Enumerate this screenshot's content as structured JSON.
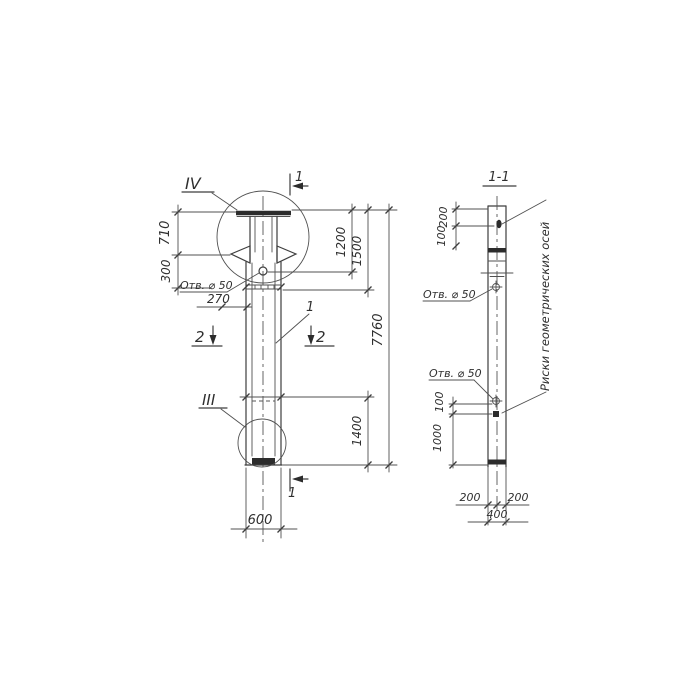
{
  "drawing": {
    "front_view": {
      "detail_top_label": "IV",
      "detail_bottom_label": "III",
      "section1_top_label": "1",
      "section1_bottom_label": "1",
      "section2_left_label": "2",
      "section2_right_label": "2",
      "part_callout": "1",
      "hole_note": "Отв. ⌀ 50",
      "dim_710": "710",
      "dim_300": "300",
      "dim_270": "270",
      "dim_1200": "1200",
      "dim_1500": "1500",
      "dim_7760": "7760",
      "dim_1400": "1400",
      "dim_600": "600"
    },
    "section_view": {
      "title": "1-1",
      "hole_note_upper": "Отв. ⌀ 50",
      "hole_note_lower": "Отв. ⌀ 50",
      "axis_marks_note": "Риски геометрических осей",
      "dim_200_top": "200",
      "dim_100_top": "100",
      "dim_100_mid": "100",
      "dim_1000": "1000",
      "dim_200_left": "200",
      "dim_200_right": "200",
      "dim_400": "400"
    },
    "colors": {
      "ink": "#3e3e3e",
      "paper": "#ffffff"
    }
  }
}
